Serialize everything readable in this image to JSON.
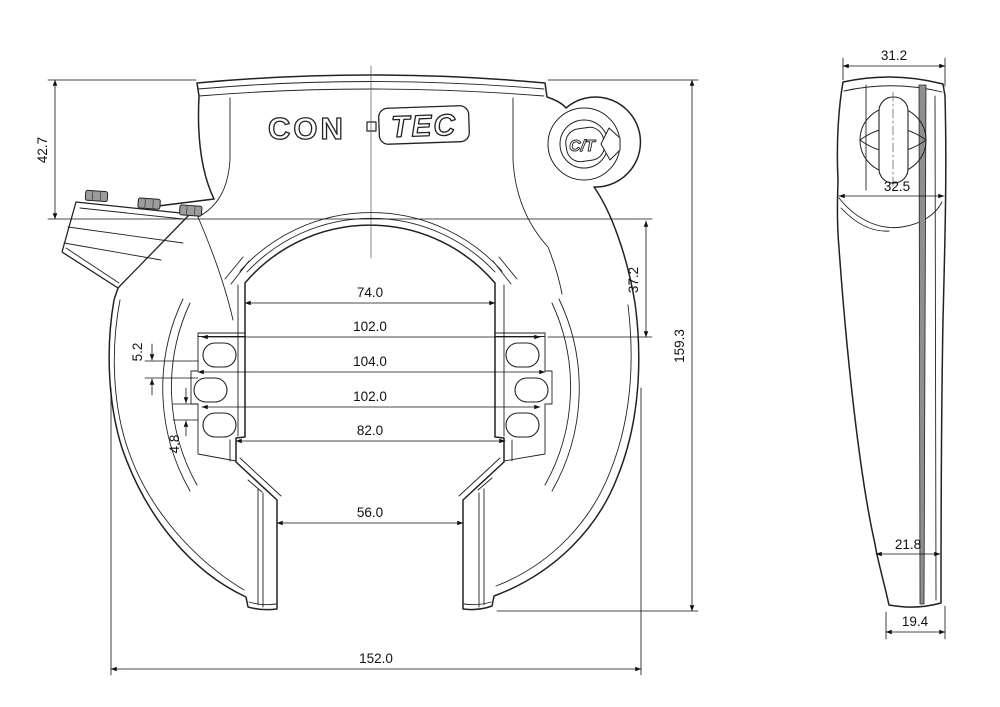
{
  "drawing": {
    "brand": {
      "con": "CON",
      "tec": "TEC",
      "separator": "·",
      "medallion": "C/T"
    },
    "front_view": {
      "dims": {
        "height_to_lever": "42.7",
        "inner_depth": "37.2",
        "overall_height": "159.3",
        "inner_top_width": "74.0",
        "slot_span_upper": "102.0",
        "pocket_span": "104.0",
        "slot_span_lower": "102.0",
        "lower_inner_width": "82.0",
        "leg_gap": "56.0",
        "overall_width": "152.0",
        "step_upper": "5.2",
        "step_lower": "4.8"
      }
    },
    "side_view": {
      "dims": {
        "top_width": "31.2",
        "head_width": "32.5",
        "body_width": "21.8",
        "foot_width": "19.4"
      }
    }
  }
}
